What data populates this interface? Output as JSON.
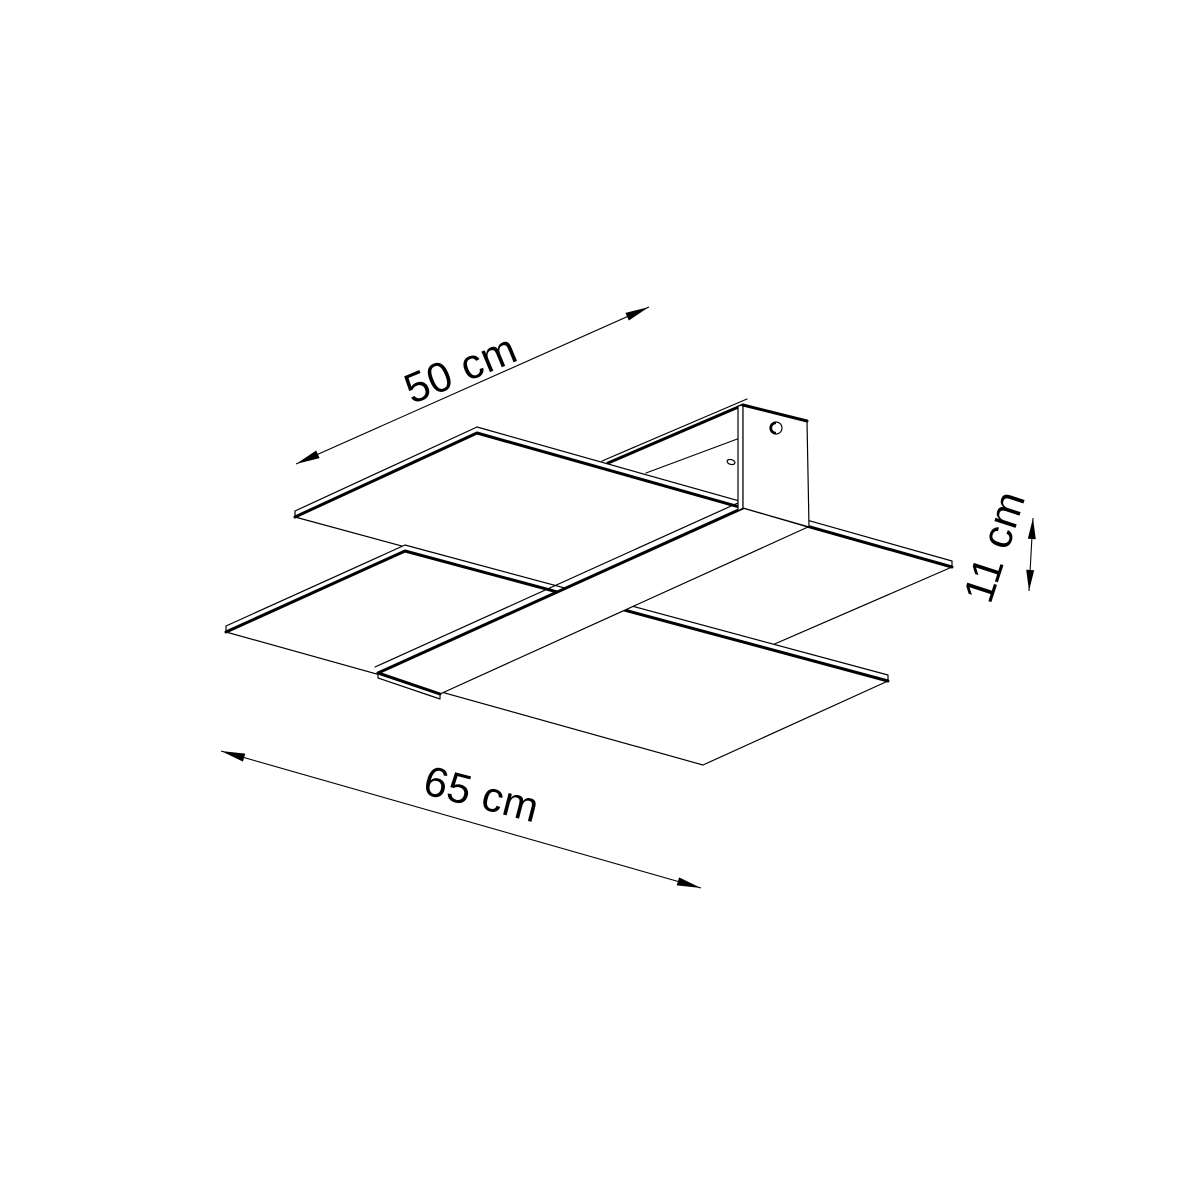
{
  "page": {
    "background": "#ffffff",
    "ink_color": "#000000"
  },
  "diagram": {
    "kind": "isometric dimensional line drawing of a ceiling light fixture",
    "parts": [
      "upper-glass-panel",
      "lower-glass-panel",
      "diagonal-cross-band",
      "ceiling-mount-rail",
      "ceiling-mount-plate",
      "screw-hole"
    ],
    "dims": {
      "depth": {
        "label": "50 cm"
      },
      "width": {
        "label": "65 cm"
      },
      "height": {
        "label": "11 cm"
      }
    }
  }
}
